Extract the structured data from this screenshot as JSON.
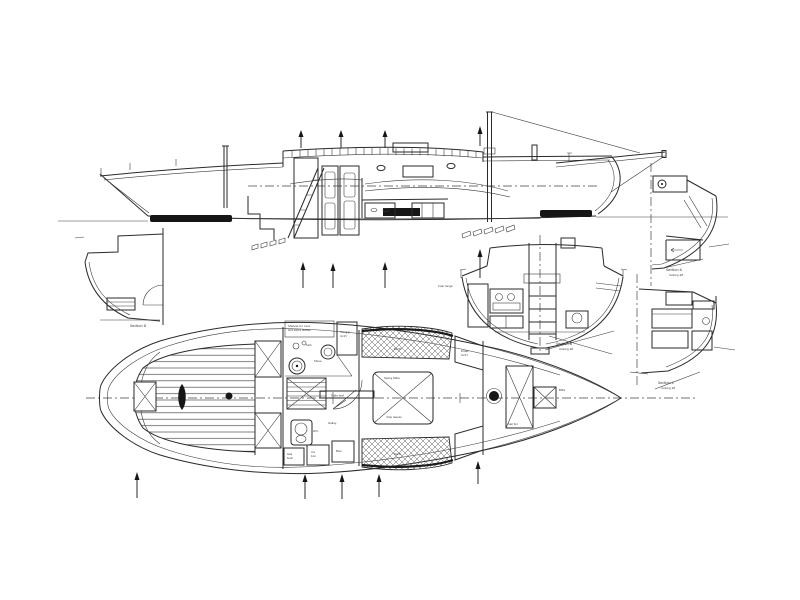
{
  "drawing_type": "boat-plans-scan",
  "colors": {
    "paper": "#ffffff",
    "ink": "#2a2a2a"
  },
  "labels": {
    "sections": {
      "a": {
        "title": "Section A",
        "sub": "looking aft"
      },
      "b": {
        "title": "Section B",
        "sub": "looking aft"
      },
      "c": {
        "title": "Section C",
        "sub": "looking aft"
      },
      "d": {
        "title": "Section D"
      }
    },
    "plan": {
      "shelves_line1": "Shelves for cans",
      "shelves_line2": "and extra dishes",
      "hanging_locker_line1": "Hang'g",
      "hanging_locker_line2": "lock'r",
      "sink": "Sink",
      "stove": "Stove",
      "galley": "Galley",
      "wc": "W.C.",
      "gas_line1": "Gas",
      "gas_line2": "tank",
      "ice_line1": "Ice",
      "ice_line2": "box",
      "bins": "Bins",
      "berth_port": "Berth",
      "berth_stbd": "Berth",
      "table_line1": "Swing table",
      "table_line2": "drop leaves",
      "table_leaf": "Table leaf",
      "locker_line1": "Dress",
      "locker_line2": "lock'r",
      "sail_bin": "Sail bin",
      "bitts": "Bitts"
    },
    "section_b_detail": {
      "range": "Coal range"
    }
  }
}
